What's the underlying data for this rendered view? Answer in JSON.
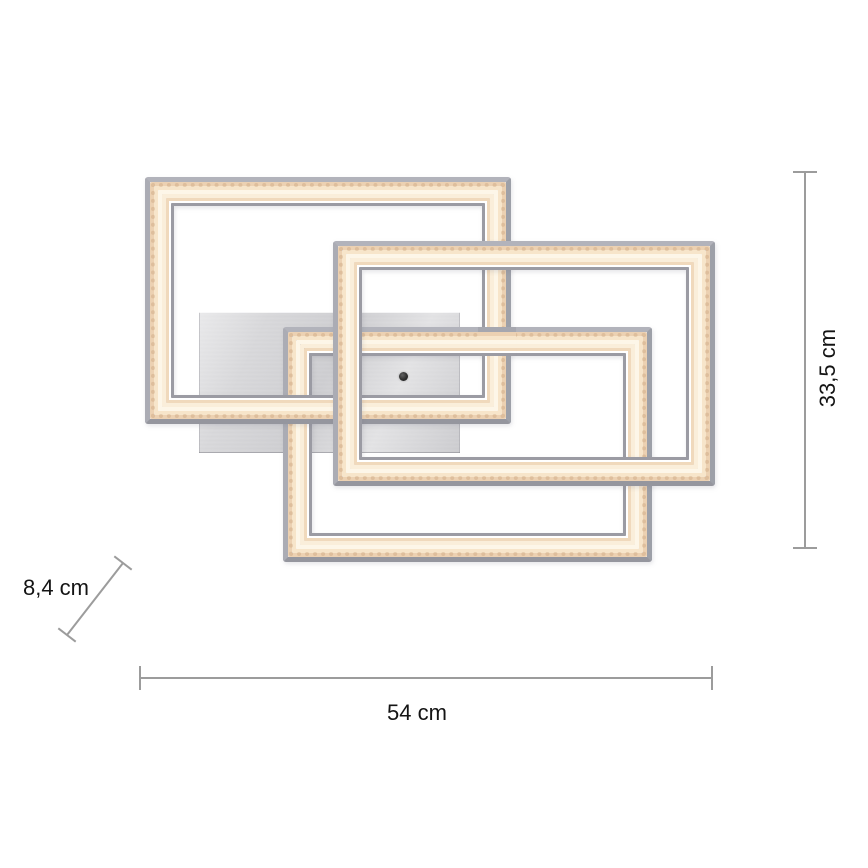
{
  "diagram": {
    "dimensions": {
      "width_label": "54 cm",
      "height_label": "33,5 cm",
      "depth_label": "8,4 cm"
    },
    "colors": {
      "background": "#ffffff",
      "chrome_edge": "#a4a4ac",
      "led_band_outer": "#ecd1b2",
      "led_band_center": "#fdf6e8",
      "inner_hairline": "#ffffff",
      "inner_edge": "#9b9ba3",
      "mount_plate": "#d6d6d8",
      "sensor_dot": "#2e2e2e",
      "dimension_line": "#9c9c9c",
      "label_text": "#141414"
    }
  }
}
